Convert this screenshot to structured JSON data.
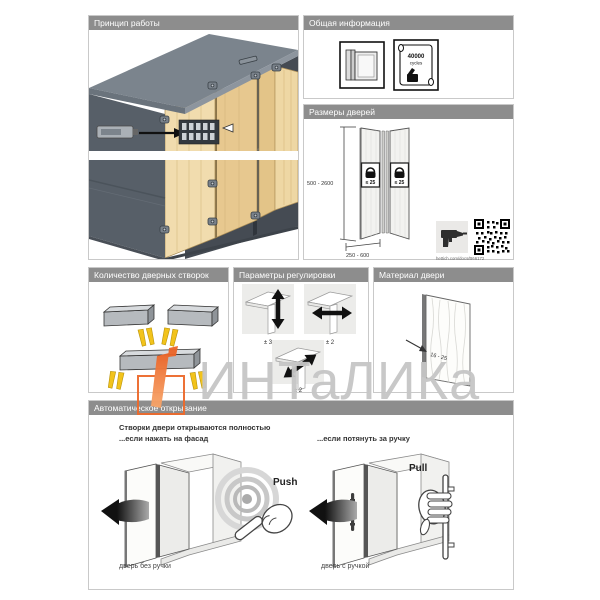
{
  "colors": {
    "header_gray": "#8d8d8d",
    "accent_orange": "#ed6a2c",
    "arrow_yellow": "#f2c31b",
    "wood": "#eed7a4",
    "watermark_gray": "#c6c6c6"
  },
  "panels": {
    "principle": {
      "title": "Принцип работы"
    },
    "general": {
      "title": "Общая информация",
      "certificate_value": "40000",
      "certificate_unit": "cycles"
    },
    "sizes": {
      "title": "Размеры дверей",
      "height_range": "500 - 2600",
      "width_range": "250 - 600",
      "weight_left": "≤ 25",
      "weight_right": "≤ 25",
      "doc_link": "hettich.com/docs/B66172"
    },
    "leaves": {
      "title": "Количество дверных створок"
    },
    "adjust": {
      "title": "Параметры регулировки",
      "vertical": "± 3",
      "horizontal": "± 2",
      "diagonal": "± 2"
    },
    "material": {
      "title": "Материал двери",
      "thickness": "16 - 25"
    },
    "auto": {
      "title": "Автоматическое открывание",
      "heading1": "Створки двери открываются полностью",
      "heading2": "...если нажать на фасад",
      "heading_right": "...если потянуть за ручку",
      "push_label": "Push",
      "pull_label": "Pull",
      "caption_left": "дверь без ручки",
      "caption_right": "дверь с ручкой"
    }
  },
  "watermark": {
    "text": "ИНТаЛИКа"
  }
}
